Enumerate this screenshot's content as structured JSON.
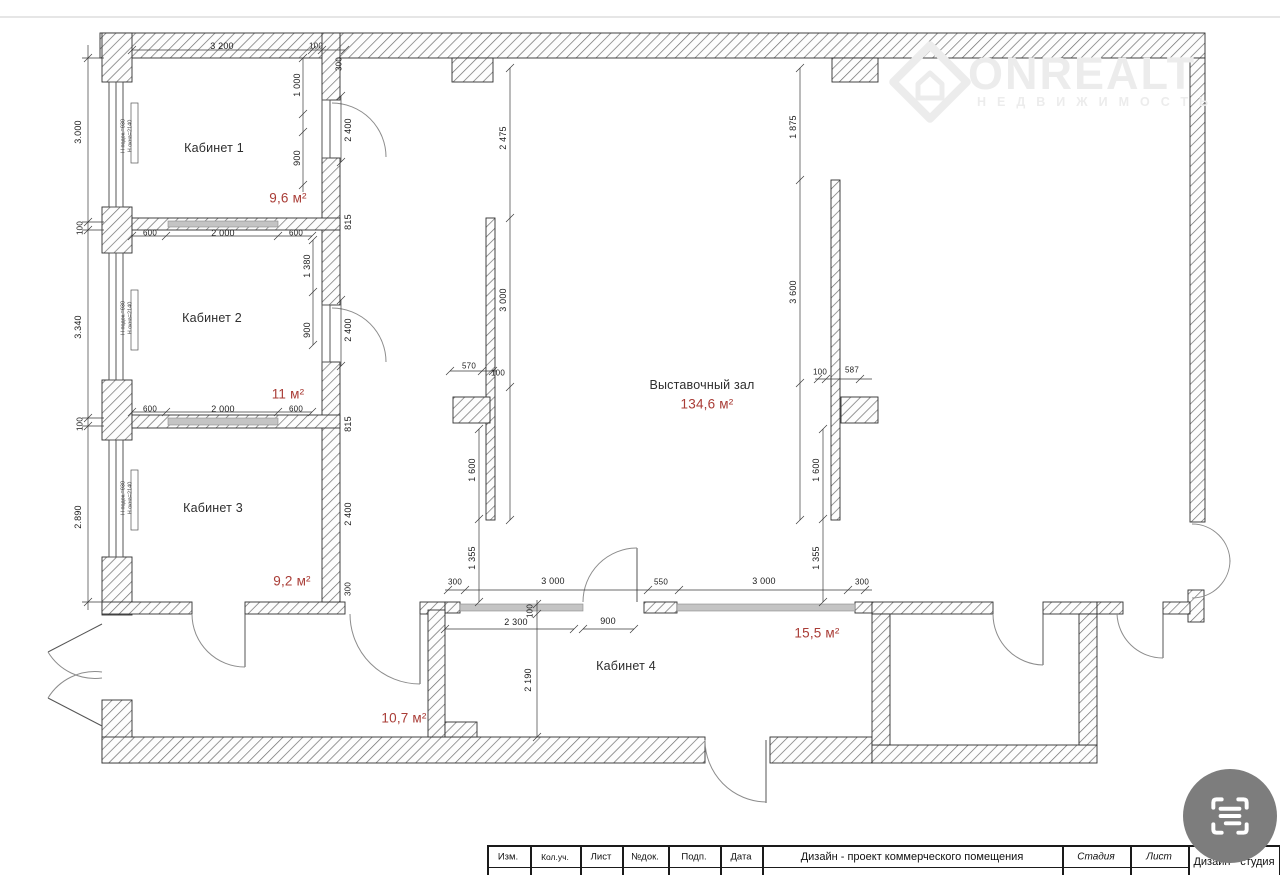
{
  "watermark": {
    "brand": "ONREALT",
    "subtitle": "НЕДВИЖИМОСТЬ"
  },
  "rooms": {
    "cab1": {
      "name": "Кабинет 1",
      "area": "9,6 м²"
    },
    "cab2": {
      "name": "Кабинет 2",
      "area": "11 м²"
    },
    "cab3": {
      "name": "Кабинет 3",
      "area": "9,2 м²"
    },
    "hall": {
      "name": "Выставочный зал",
      "area": "134,6 м²"
    },
    "cab4": {
      "name": "Кабинет 4",
      "area": "15,5 м²"
    },
    "corridor": {
      "area": "10,7 м²"
    }
  },
  "dims": {
    "left": [
      "3.000",
      "100",
      "3.340",
      "100",
      "2.890"
    ],
    "top": [
      "3 200",
      "100",
      "300"
    ],
    "wall_col": [
      "1 000",
      "900",
      "2 400",
      "815",
      "1 380",
      "900",
      "2 400",
      "815",
      "2 400",
      "300"
    ],
    "row12": [
      "600",
      "2 000",
      "600"
    ],
    "row23": [
      "600",
      "2 000",
      "600"
    ],
    "hall_left": [
      "2 475",
      "3 000",
      "570",
      "100",
      "1 600",
      "1 355"
    ],
    "hall_right": [
      "1 875",
      "3 600",
      "100",
      "587",
      "1 600",
      "1 355"
    ],
    "bottom": [
      "300",
      "3 000",
      "550",
      "3 000",
      "300"
    ],
    "cab4": [
      "2 300",
      "100",
      "900",
      "2 190"
    ]
  },
  "window_note": {
    "l1": "Н подок.=930",
    "l2": "Н окна=2140"
  },
  "titleblock": {
    "cols": [
      "Изм.",
      "Кол.уч.",
      "Лист",
      "№док.",
      "Подп.",
      "Дата"
    ],
    "project": "Дизайн - проект коммерческого помещения",
    "stage_label": "Стадия",
    "sheet_label": "Лист",
    "studio": "Дизайн - студия"
  },
  "colors": {
    "area_red": "#a93c36",
    "wall_ink": "#333333",
    "fab_grey": "#7d7d7d"
  }
}
